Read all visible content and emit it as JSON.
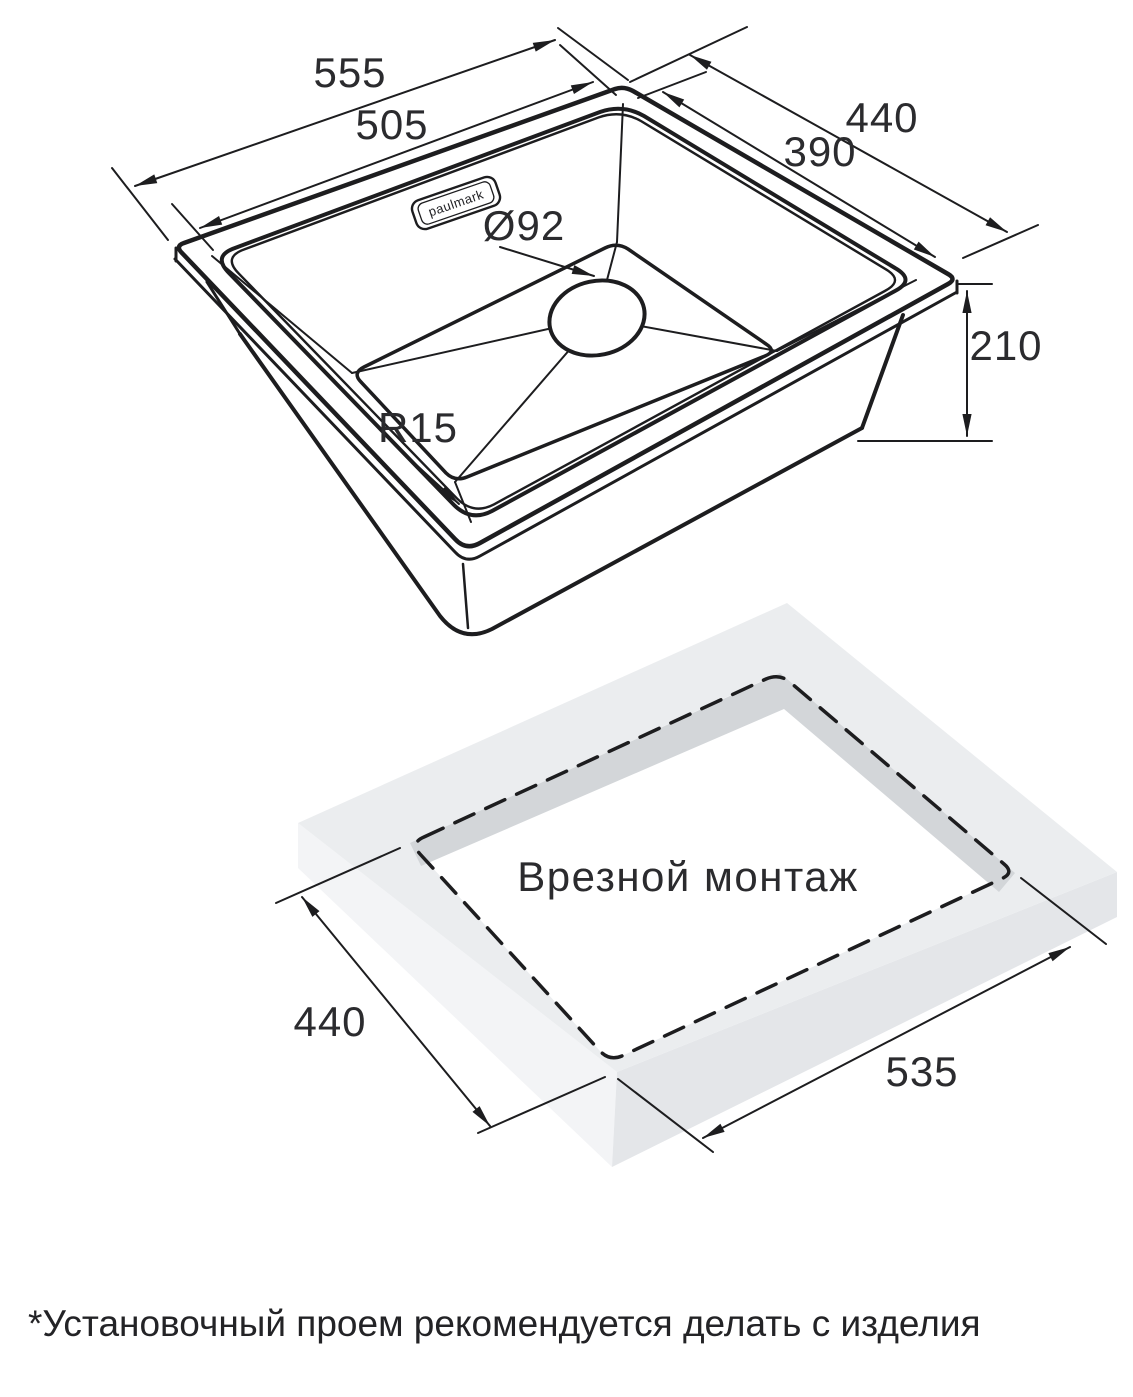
{
  "top_view": {
    "logo": "paulmark",
    "dim_outer_width": "555",
    "dim_inner_width": "505",
    "dim_outer_depth": "440",
    "dim_inner_depth": "390",
    "dim_drain_diameter": "Ø92",
    "dim_height": "210",
    "dim_corner_radius": "R15"
  },
  "bottom_view": {
    "title": "Врезной монтаж",
    "dim_cutout_depth": "440",
    "dim_cutout_width": "535"
  },
  "footnote": "*Установочный проем рекомендуется делать с изделия",
  "colors": {
    "line": "#1d1d1f",
    "text": "#2b2b2e",
    "countertop_top": "#ebedef",
    "countertop_left_side": "#f3f4f6",
    "countertop_right_side": "#e4e6e9",
    "cutout_wall": "#d3d6d9"
  }
}
